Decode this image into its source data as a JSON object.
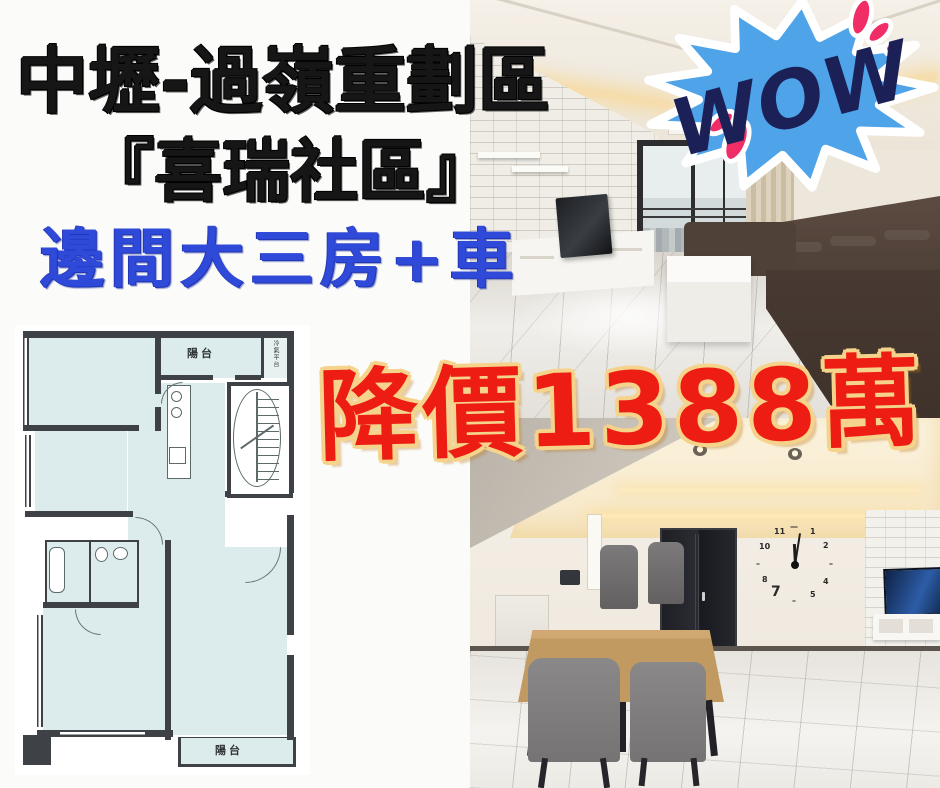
{
  "headline": {
    "line1": "中壢-過嶺重劃區",
    "line2": "『喜瑞社區』",
    "line3": "邊間大三房+車"
  },
  "wow": {
    "label": "WOW"
  },
  "price": {
    "label": "降價1388萬"
  },
  "floorplan": {
    "balcony_top": "陽台",
    "ac_platform": "冷氣平台",
    "balcony_bottom": "陽台"
  },
  "clock": {
    "n12": "—",
    "n1": "1",
    "n2": "2",
    "n3": "–",
    "n4": "4",
    "n5": "5",
    "n6": "–",
    "n7": "7",
    "n8": "8",
    "n9": "–",
    "n10": "10",
    "n11": "11"
  },
  "colors": {
    "headline_black": "#161616",
    "headline_blue": "#2f49d8",
    "price_red": "#ee1d13",
    "price_outline": "#f6d38b",
    "wow_burst_blue": "#4fa3e9",
    "wow_text_navy": "#1b2157",
    "wow_accent_pink": "#f12d68",
    "plan_room_fill": "#dcecec",
    "plan_wall": "#3e4145"
  }
}
